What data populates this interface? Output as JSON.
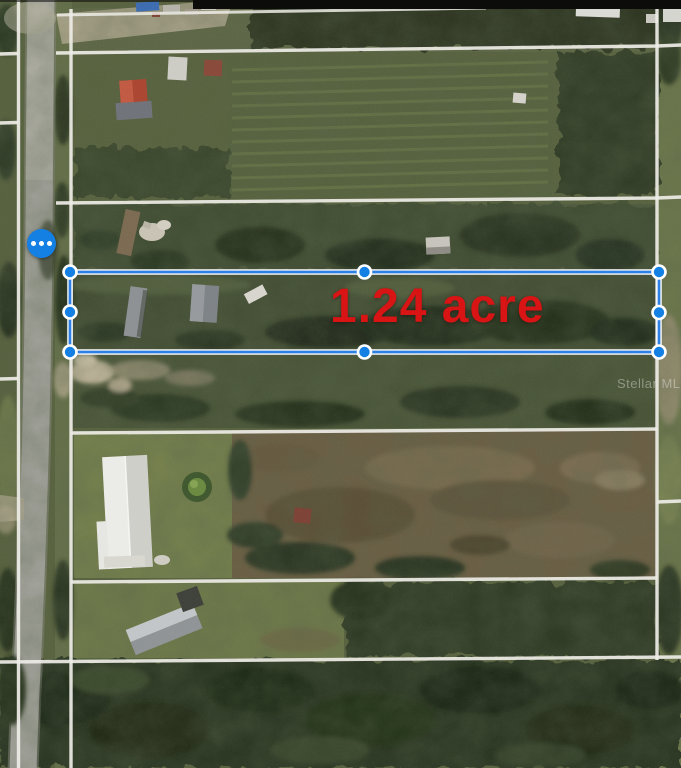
{
  "colors": {
    "label_red": "#d81414",
    "accent_blue": "#1580e4",
    "selection_blue": "#2f80e4",
    "parcel_line": "#edece6"
  },
  "map": {
    "parcel_label": {
      "text": "1.24 acre"
    },
    "watermark": {
      "text": "Stellar MLS"
    },
    "options_button": {
      "icon": "ellipsis-icon"
    },
    "selection": {
      "handles": [
        "top-left",
        "top-middle",
        "top-right",
        "left-middle",
        "right-middle",
        "bottom-left",
        "bottom-middle",
        "bottom-right"
      ]
    }
  }
}
